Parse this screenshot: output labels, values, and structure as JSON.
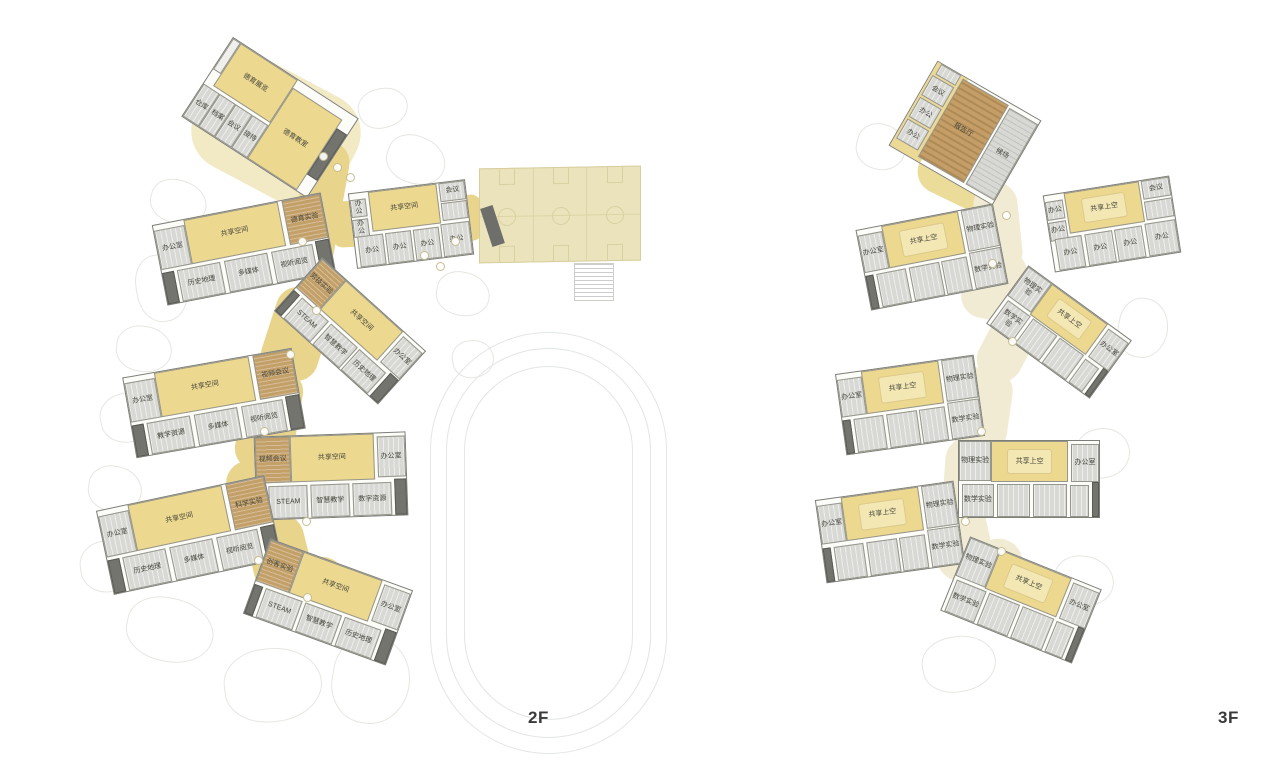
{
  "colors": {
    "circulation_yellow": "#e8d48b",
    "shared_space_yellow": "#ecd98f",
    "special_room_brown": "#c4a069",
    "classroom_gray": "#d8d8d4",
    "terrace_cream": "#ebe3bb"
  },
  "sports_terrace": {
    "basketball_courts": 3
  },
  "floors": [
    {
      "label": "2F",
      "wings": [
        {
          "name": "moral-education-wing",
          "rooms": [
            {
              "label": "德育展览"
            },
            {
              "label": "德育教室"
            },
            {
              "label": "仓库"
            },
            {
              "label": "档案"
            },
            {
              "label": "会议"
            },
            {
              "label": "接待"
            }
          ]
        },
        {
          "name": "cluster-north",
          "rooms": [
            {
              "label": "办公室"
            },
            {
              "label": "共享空间"
            },
            {
              "label": "德育实验"
            },
            {
              "label": "历史地理"
            },
            {
              "label": "多媒体"
            },
            {
              "label": "视听阅览"
            }
          ]
        },
        {
          "name": "office-wing",
          "rooms": [
            {
              "label": "共享空间"
            },
            {
              "label": "会议"
            },
            {
              "label": "办公"
            },
            {
              "label": "办公"
            },
            {
              "label": "办公"
            },
            {
              "label": "办公"
            },
            {
              "label": "办公"
            },
            {
              "label": "办公"
            }
          ]
        },
        {
          "name": "cluster-mid",
          "rooms": [
            {
              "label": "劳技实验"
            },
            {
              "label": "共享空间"
            },
            {
              "label": "办公室"
            },
            {
              "label": "STEAM"
            },
            {
              "label": "智慧教学"
            },
            {
              "label": "历史地理"
            }
          ]
        },
        {
          "name": "cluster-west",
          "rooms": [
            {
              "label": "办公室"
            },
            {
              "label": "共享空间"
            },
            {
              "label": "视频会议"
            },
            {
              "label": "教学资源"
            },
            {
              "label": "多媒体"
            },
            {
              "label": "视听阅览"
            }
          ]
        },
        {
          "name": "cluster-central",
          "rooms": [
            {
              "label": "视频会议"
            },
            {
              "label": "共享空间"
            },
            {
              "label": "办公室"
            },
            {
              "label": "STEAM"
            },
            {
              "label": "智慧教学"
            },
            {
              "label": "数字资源"
            }
          ]
        },
        {
          "name": "cluster-southwest",
          "rooms": [
            {
              "label": "办公室"
            },
            {
              "label": "共享空间"
            },
            {
              "label": "科学实验"
            },
            {
              "label": "历史地理"
            },
            {
              "label": "多媒体"
            },
            {
              "label": "视听阅览"
            }
          ]
        },
        {
          "name": "cluster-south",
          "rooms": [
            {
              "label": "创客实验"
            },
            {
              "label": "共享空间"
            },
            {
              "label": "办公室"
            },
            {
              "label": "STEAM"
            },
            {
              "label": "智慧教学"
            },
            {
              "label": "历史地理"
            }
          ]
        }
      ]
    },
    {
      "label": "3F",
      "wings": [
        {
          "name": "auditorium-wing",
          "rooms": [
            {
              "label": "会议"
            },
            {
              "label": "办公"
            },
            {
              "label": "办公"
            },
            {
              "label": "报告厅"
            },
            {
              "label": "候场"
            }
          ]
        },
        {
          "name": "office-wing",
          "rooms": [
            {
              "label": "共享上空"
            },
            {
              "label": "会议"
            },
            {
              "label": "办公"
            },
            {
              "label": "办公"
            },
            {
              "label": "办公"
            },
            {
              "label": "办公"
            },
            {
              "label": "办公"
            },
            {
              "label": "办公"
            }
          ]
        },
        {
          "name": "cluster-north",
          "rooms": [
            {
              "label": "办公室"
            },
            {
              "label": "共享上空"
            },
            {
              "label": "物理实验"
            },
            {
              "label": "数学实验"
            }
          ]
        },
        {
          "name": "cluster-mid",
          "rooms": [
            {
              "label": "物理实验"
            },
            {
              "label": "共享上空"
            },
            {
              "label": "办公室"
            },
            {
              "label": "数学实验"
            }
          ]
        },
        {
          "name": "cluster-west",
          "rooms": [
            {
              "label": "办公室"
            },
            {
              "label": "共享上空"
            },
            {
              "label": "物理实验"
            },
            {
              "label": "数学实验"
            }
          ]
        },
        {
          "name": "cluster-central",
          "rooms": [
            {
              "label": "物理实验"
            },
            {
              "label": "共享上空"
            },
            {
              "label": "办公室"
            },
            {
              "label": "数学实验"
            }
          ]
        },
        {
          "name": "cluster-southwest",
          "rooms": [
            {
              "label": "办公室"
            },
            {
              "label": "共享上空"
            },
            {
              "label": "物理实验"
            },
            {
              "label": "数学实验"
            }
          ]
        },
        {
          "name": "cluster-south",
          "rooms": [
            {
              "label": "物理实验"
            },
            {
              "label": "共享上空"
            },
            {
              "label": "办公室"
            },
            {
              "label": "数学实验"
            }
          ]
        }
      ]
    }
  ]
}
